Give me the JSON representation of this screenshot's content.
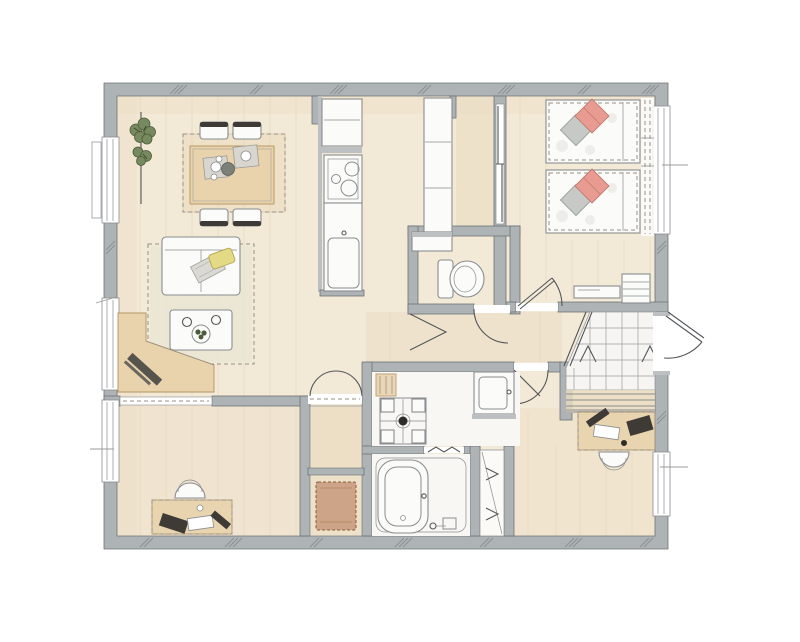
{
  "plan": {
    "colors": {
      "paper": "#ffffff",
      "wall": "#aeb3b5",
      "wall-edge": "#6f7478",
      "floor": "#f3e9d7",
      "floor-warm": "#eadcc1",
      "fixture": "#fbfbf9",
      "line": "#8a8d8f",
      "dark-line": "#54575a",
      "dash": "#97918a",
      "tan": "#e9d3ad",
      "tan-edge": "#b3945f",
      "rug": "#eae6d4",
      "tile": "#f6f5f1",
      "tile-line": "#9b9ea0",
      "salmon": "#e89c91",
      "salmon-edge": "#c2766c",
      "pillow-gray": "#c6c9c6",
      "yellow": "#e4da86",
      "yellow-edge": "#b1a64e",
      "green": "#77895e",
      "green-dark": "#4b5b38",
      "chair-dark": "#3e3b37",
      "mat-brown": "#cda488",
      "mat-brown-edge": "#8e5a36"
    },
    "fixtures": [
      "potted-plant",
      "dining-table",
      "dining-chair",
      "place-setting",
      "sofa",
      "throw-pillow",
      "living-rug",
      "coffee-table",
      "corner-desk",
      "refrigerator",
      "cooktop",
      "kitchen-sink",
      "tall-cabinet",
      "sliding-door",
      "bed",
      "pillow",
      "window-curtain",
      "tv-bench",
      "drawer-chest",
      "toilet",
      "hand-wash-shelf",
      "washing-machine-pan",
      "vanity-basin",
      "bathtub",
      "shower-stool",
      "closet",
      "closet-mat",
      "study-desk",
      "study-chair",
      "entrance-tiles",
      "entrance-steps",
      "entry-door",
      "door-swing"
    ]
  }
}
